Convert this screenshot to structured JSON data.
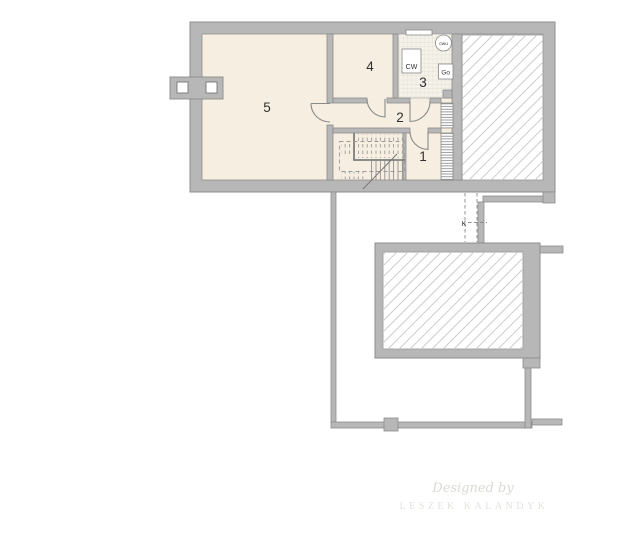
{
  "plan": {
    "type": "basement floor plan",
    "rooms": [
      {
        "id": "room-5",
        "label": "5"
      },
      {
        "id": "room-4",
        "label": "4"
      },
      {
        "id": "room-3",
        "label": "3"
      },
      {
        "id": "room-2",
        "label": "2"
      },
      {
        "id": "room-1",
        "label": "1"
      }
    ],
    "equipment": {
      "boiler_label": "CW",
      "hot_water_tank_label": "cwu",
      "gas_meter_label": "Go",
      "flue_label": "K"
    },
    "colors": {
      "wall": "#b7b7b7",
      "wall_outline": "#8c8c8c",
      "floor": "#f6efe1",
      "tile_floor": "#f5f2ea",
      "hatch_line": "#cdcdcd",
      "background": "#ffffff"
    }
  },
  "watermark": {
    "line1": "Designed by",
    "line2": "LESZEK KALANDYK"
  }
}
